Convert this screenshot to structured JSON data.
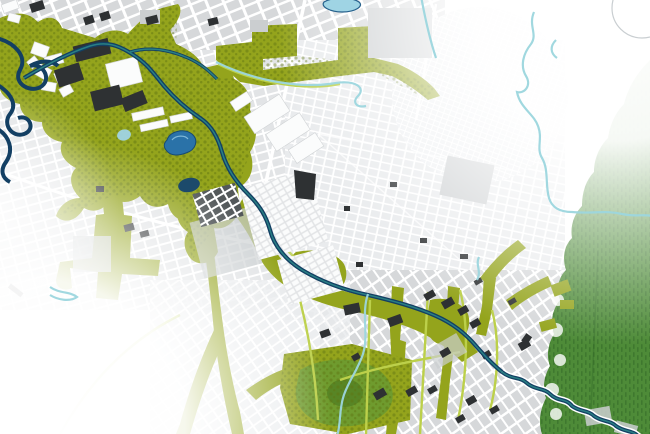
{
  "map": {
    "kind": "urban-masterplan-aerial-map",
    "features": [
      "urban street-grid districts",
      "green corridor network",
      "central river channel",
      "meandering rivers",
      "light streams",
      "ponds and lakes",
      "dark building footprints",
      "white building clusters",
      "large forest area on east edge",
      "pentagonal park",
      "faded map edges"
    ]
  },
  "colors": {
    "background": "#ffffff",
    "street": "#ffffff",
    "urban_block_strong": "#d6d8da",
    "urban_block": "#e2e4e6",
    "urban_block_faint": "#e9ebed",
    "urban_block_fainter": "#eef0f2",
    "urban_block_md": "#cbced0",
    "dense_block": "#53585a",
    "building_dark": "#2e3133",
    "building_white": "#fbfcfc",
    "green_corridor": "#94a41c",
    "green_corridor_light": "#bcd04a",
    "green_dark": "#5e7312",
    "park_green": "#6f9b2e",
    "park_dark": "#49761f",
    "forest_green": "#4e8b38",
    "forest_dark": "#2f6526",
    "river_navy": "#133f63",
    "river_teal": "#2e8b8a",
    "stream_cyan": "#9cd6de",
    "lake_blue": "#2a72a8",
    "lake_cyan": "#9fd4e4",
    "pond_dark": "#1c4a6b",
    "faint_line": "#c9ced1"
  }
}
